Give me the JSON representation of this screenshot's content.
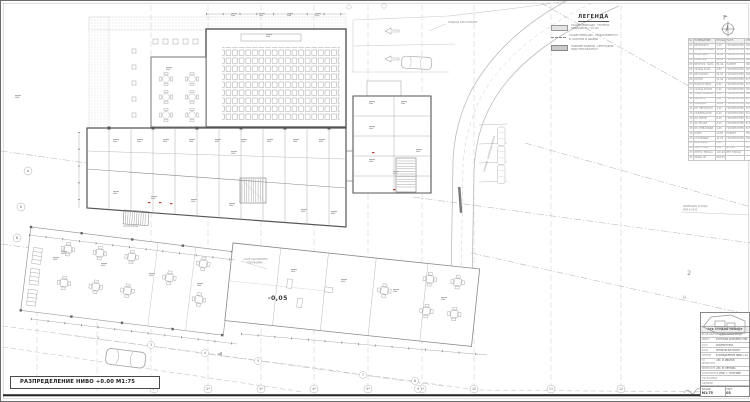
{
  "drawing": {
    "title": "РАЗПРЕДЕЛЕНИЕ НИВО +0.00 М1:75",
    "level_label": "-0,05",
    "entry_label": "±0,00 ВХОД",
    "platform_note_1": "+0,05 АСАНСЬОРНА",
    "platform_note_2": "ПЛАТФОРМА",
    "road_note": "ПОДХОД КЪМ ПАРКИНГ",
    "sidewalk_note": "ТРОТОАР - БЕТОНОВИ ПЛОЧИ",
    "boundary_note_1": "ЖИЛИЩНА СГРАДА",
    "boundary_note_2": "УПИ II-2043",
    "right_label_big": "2",
    "right_label_small": "Н"
  },
  "axes": {
    "bottom": [
      "1*",
      "2*",
      "3*",
      "4*",
      "5*",
      "6*",
      "10",
      "11",
      "12"
    ],
    "stations": [
      "2",
      "3",
      "4",
      "5",
      "7",
      "8",
      "9"
    ],
    "left": [
      "А",
      "Б",
      "В"
    ]
  },
  "legend": {
    "title": "ЛЕГЕНДА",
    "items": [
      {
        "line1": "СЪЩЕСТВУВАЩИ - ТУХЛЕНА",
        "line2": "ЗИДАРИЯ 25 / 12 СМ"
      },
      {
        "line1": "СЪЩЕСТВУВАЩИ - СТОМАНОБЕТОН",
        "line2": "Б. КОЛОНИ И ШАЙБИ"
      },
      {
        "line1": "НОВОИЗГРАДЕНИ - ПРЕГРАДНИ",
        "line2": "ЗИД ГИПСОКАРТОН"
      }
    ]
  },
  "schedule": {
    "columns": [
      "№",
      "ПОМЕЩЕНИЕ",
      "ПЛОЩ",
      "НАСТ.",
      "СТЕНИ",
      "ТАВАН",
      "ЗАБ."
    ],
    "rows": [
      {
        "n": "01",
        "name": "ВЕТРОБРАН",
        "area": "4.20",
        "floor": "ГРАНИТОГРЕС",
        "walls": "ЛАТЕКС",
        "ceil": "ОК.ТАВАН",
        "note": ""
      },
      {
        "n": "02",
        "name": "ВХОДНО ФОАЙЕ",
        "area": "32.60",
        "floor": "ГРАНИТОГРЕС",
        "walls": "ЛАТЕКС",
        "ceil": "ОК.ТАВАН",
        "note": ""
      },
      {
        "n": "03",
        "name": "РЕЦЕПЦИЯ",
        "area": "12.40",
        "floor": "ГРАНИТОГРЕС",
        "walls": "ЛАТЕКС",
        "ceil": "ОК.ТАВАН",
        "note": ""
      },
      {
        "n": "04",
        "name": "ЛОБИ БАР",
        "area": "46.80",
        "floor": "ГРАНИТОГРЕС",
        "walls": "ЛАТЕКС",
        "ceil": "ОК.ТАВАН",
        "note": ""
      },
      {
        "n": "05",
        "name": "МНОГОФ. ЗАЛА",
        "area": "86.40",
        "floor": "ПАРКЕТ",
        "walls": "ЛАТЕКС",
        "ceil": "ОК.ТАВАН",
        "note": ""
      },
      {
        "n": "06",
        "name": "СКЛАД ЗАЛА",
        "area": "6.80",
        "floor": "ГРАНИТОГРЕС",
        "walls": "ЛАТЕКС",
        "ceil": "ЛАТЕКС",
        "note": ""
      },
      {
        "n": "07",
        "name": "РЕСТОРАНТ",
        "area": "64.20",
        "floor": "ГРАНИТОГРЕС",
        "walls": "ЛАТЕКС",
        "ceil": "ОК.ТАВАН",
        "note": ""
      },
      {
        "n": "08",
        "name": "КУХНЯ",
        "area": "22.40",
        "floor": "ГРАНИТОГРЕС",
        "walls": "Ф.ПЛОЧКИ",
        "ceil": "ОК.ТАВАН",
        "note": ""
      },
      {
        "n": "09",
        "name": "ПОДГОТОВКА",
        "area": "8.60",
        "floor": "ГРАНИТОГРЕС",
        "walls": "Ф.ПЛОЧКИ",
        "ceil": "ОК.ТАВАН",
        "note": ""
      },
      {
        "n": "10",
        "name": "СКЛАД ХРАНИ",
        "area": "5.40",
        "floor": "ГРАНИТОГРЕС",
        "walls": "ЛАТЕКС",
        "ceil": "ЛАТЕКС",
        "note": ""
      },
      {
        "n": "11",
        "name": "ХЛАД. КАМЕРА",
        "area": "4.80",
        "floor": "ГРАНИТОГРЕС",
        "walls": "ПАНЕЛ",
        "ceil": "ПАНЕЛ",
        "note": ""
      },
      {
        "n": "12",
        "name": "МИЯЛНО",
        "area": "6.20",
        "floor": "ГРАНИТОГРЕС",
        "walls": "Ф.ПЛОЧКИ",
        "ceil": "ОК.ТАВАН",
        "note": ""
      },
      {
        "n": "13",
        "name": "КОРИДОР",
        "area": "18.20",
        "floor": "ГРАНИТОГРЕС",
        "walls": "ЛАТЕКС",
        "ceil": "ОК.ТАВАН",
        "note": ""
      },
      {
        "n": "14",
        "name": "WC ПЕРСОНАЛ",
        "area": "3.20",
        "floor": "ГРАНИТОГРЕС",
        "walls": "Ф.ПЛОЧКИ",
        "ceil": "ОК.ТАВАН",
        "note": ""
      },
      {
        "n": "15",
        "name": "СЪБЛЕКАЛНЯ",
        "area": "6.40",
        "floor": "ГРАНИТОГРЕС",
        "walls": "Ф.ПЛОЧКИ",
        "ceil": "ОК.ТАВАН",
        "note": ""
      },
      {
        "n": "16",
        "name": "WC ЖЕНИ",
        "area": "8.20",
        "floor": "ГРАНИТОГРЕС",
        "walls": "Ф.ПЛОЧКИ",
        "ceil": "ОК.ТАВАН",
        "note": ""
      },
      {
        "n": "17",
        "name": "WC МЪЖЕ",
        "area": "8.20",
        "floor": "ГРАНИТОГРЕС",
        "walls": "Ф.ПЛОЧКИ",
        "ceil": "ОК.ТАВАН",
        "note": ""
      },
      {
        "n": "18",
        "name": "WC ИНВАЛИДИ",
        "area": "4.60",
        "floor": "ГРАНИТОГРЕС",
        "walls": "Ф.ПЛОЧКИ",
        "ceil": "ОК.ТАВАН",
        "note": ""
      },
      {
        "n": "19",
        "name": "ОФИС",
        "area": "10.80",
        "floor": "ПАРКЕТ",
        "walls": "ЛАТЕКС",
        "ceil": "ЛАТЕКС",
        "note": ""
      },
      {
        "n": "20",
        "name": "СТЪЛБИЩЕ",
        "area": "14.20",
        "floor": "ГРАНИТОГРЕС",
        "walls": "ЛАТЕКС",
        "ceil": "ЛАТЕКС",
        "note": ""
      },
      {
        "n": "21",
        "name": "АСАНСЬОР",
        "area": "3.60",
        "floor": "-",
        "walls": "-",
        "ceil": "-",
        "note": ""
      },
      {
        "n": "22",
        "name": "ТЕХН. ПОМ.",
        "area": "9.40",
        "floor": "БЕТОН",
        "walls": "ЛАТЕКС",
        "ceil": "ЛАТЕКС",
        "note": ""
      },
      {
        "n": "23",
        "name": "ЛЯТНА ТЕРАСА",
        "area": "120.40",
        "floor": "БЕТ.ПЛОЧИ",
        "walls": "-",
        "ceil": "-",
        "note": ""
      },
      {
        "n": "24",
        "name": "ОБЩО ЗП",
        "area": "548.60",
        "floor": "",
        "walls": "",
        "ceil": "",
        "note": ""
      }
    ]
  },
  "title_block": {
    "firm": "АРХ СТУДИО ПРОЕКТ",
    "rows": [
      {
        "k": "ВЪЗЛОЖИТЕЛ",
        "v": "ИНВЕСТИТОР ЕООД"
      },
      {
        "k": "ОБЕКТ",
        "v": "ХОТЕЛСКИ КОМПЛЕКС УПИ III-2044"
      },
      {
        "k": "ЧАСТ",
        "v": "АРХИТЕКТУРНА"
      },
      {
        "k": "ФАЗА",
        "v": "ТЕХНИЧЕСКИ ПРОЕКТ"
      },
      {
        "k": "ЧЕРТЕЖ",
        "v": "РАЗПРЕДЕЛЕНИЕ НИВО +0.00"
      }
    ],
    "signatures": [
      {
        "k": "ГЛ. ПРОЕКТАНТ",
        "v": "АРХ. И. ИВАНОВ"
      },
      {
        "k": "ПРОЕКТАНТ",
        "v": "АРХ. М. ПЕТРОВА"
      },
      {
        "k": "КОНСТРУКТОР",
        "v": "ИНЖ. Г. ГЕОРГИЕВ"
      },
      {
        "k": "СЪГЛАСУВАЛ",
        "v": ""
      },
      {
        "k": "ОДОБРИЛ",
        "v": ""
      }
    ],
    "scale_label": "МАЩАБ",
    "scale": "М1:75",
    "sheet_label": "ЛИСТ",
    "sheet": "03"
  }
}
